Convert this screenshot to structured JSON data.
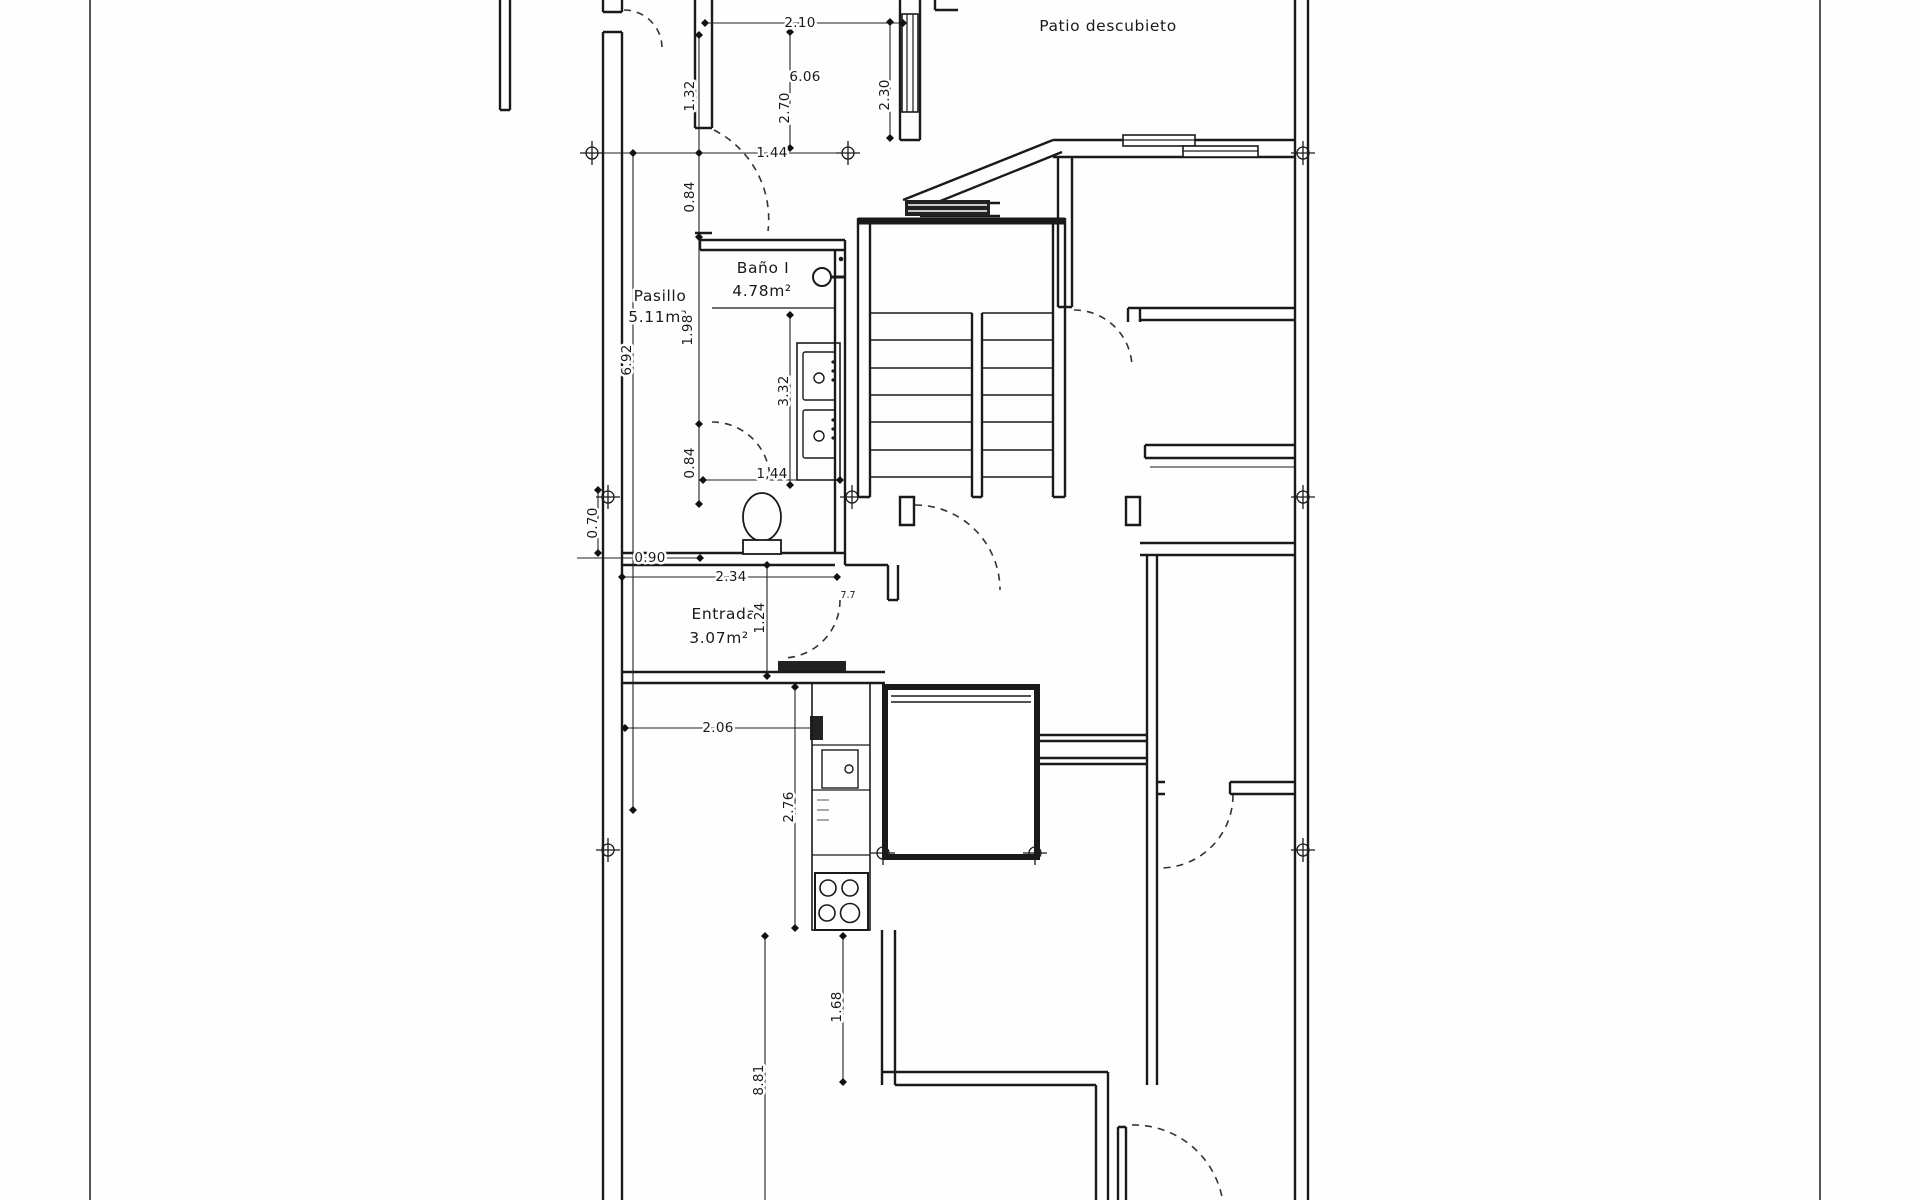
{
  "floor_plan": {
    "rooms": [
      {
        "name": "Patio descubieto",
        "area": ""
      },
      {
        "name": "Baño I",
        "area": "4.78m²"
      },
      {
        "name": "Pasillo",
        "area": "5.11m²"
      },
      {
        "name": "Entrada",
        "area": "3.07m²"
      }
    ],
    "dimensions": {
      "room_top_width": "2.10",
      "room_area_length": "6.06",
      "room_height": "2.70",
      "window_segment": "2.30",
      "left_segment_upper": "1.32",
      "door_top": "1.44",
      "gap_upper": "0.84",
      "pasillo_length": "1.98",
      "corridor_total": "6.92",
      "vanity_length": "3.32",
      "gap_lower": "0.84",
      "wc_door": "1,44",
      "wc_depth": "0.70",
      "entry_offset": "0.90",
      "entry_width": "2.34",
      "entry_depth": "1.24",
      "door_mark": "7.7",
      "kitchen_width": "2.06",
      "kitchen_length": "2.76",
      "stove_to_wall": "1.68",
      "bottom_length": "8.81"
    },
    "colors": {
      "ink": "#1a1a1a",
      "paper": "#ffffff"
    }
  }
}
